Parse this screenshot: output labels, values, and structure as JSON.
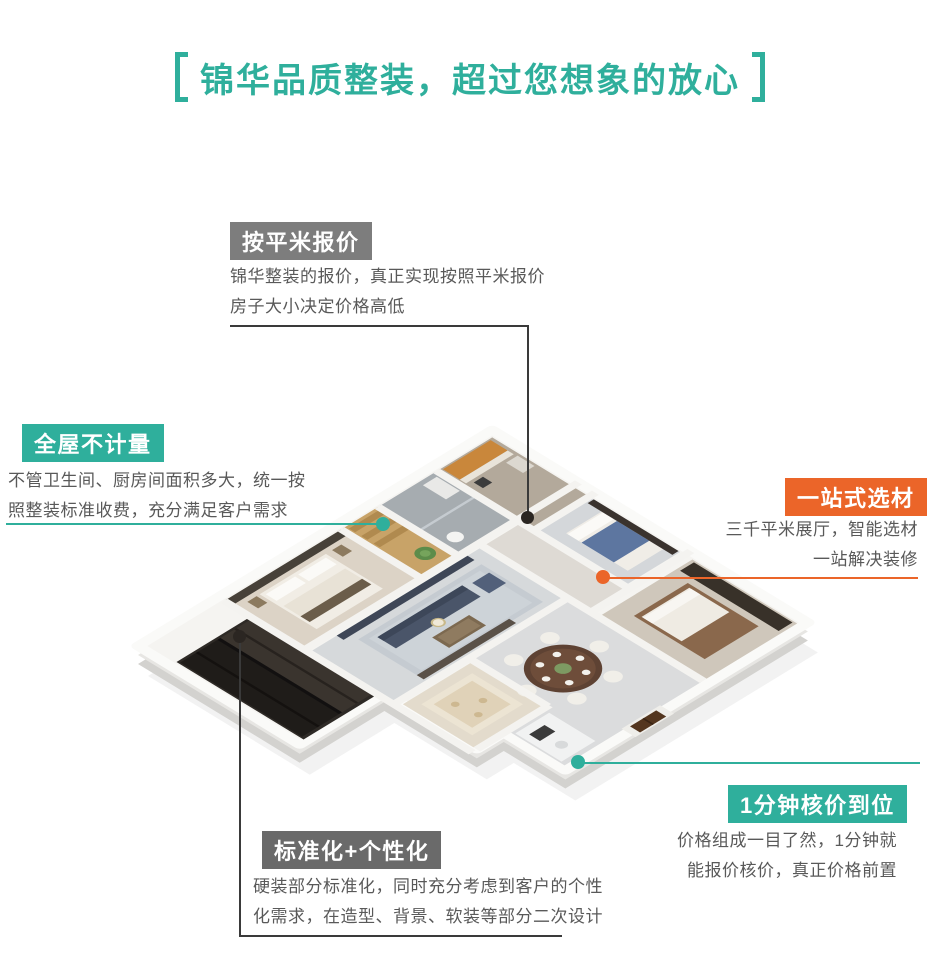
{
  "page": {
    "title": "锦华品质整装，超过您想象的放心"
  },
  "colors": {
    "teal": "#2FAF9C",
    "orange": "#EB6529",
    "gray_label": "#7D7D7D",
    "dark_gray_label": "#6A6A6A",
    "connector_dark": "#3A3A3A",
    "body_text": "#595959"
  },
  "callouts": [
    {
      "id": "price-per-sqm",
      "label": "按平米报价",
      "accent": "gray",
      "lines": [
        "锦华整装的报价，真正实现按照平米报价",
        "房子大小决定价格高低"
      ]
    },
    {
      "id": "whole-house-no-metering",
      "label": "全屋不计量",
      "accent": "teal",
      "lines": [
        "不管卫生间、厨房间面积多大，统一按",
        "照整装标准收费，充分满足客户需求"
      ]
    },
    {
      "id": "one-stop-materials",
      "label": "一站式选材",
      "accent": "orange",
      "lines": [
        "三千平米展厅，智能选材",
        "一站解决装修"
      ]
    },
    {
      "id": "one-minute-pricing",
      "label": "1分钟核价到位",
      "accent": "teal",
      "lines": [
        "价格组成一目了然，1分钟就",
        "能报价核价，真正价格前置"
      ]
    },
    {
      "id": "standardized-personalized",
      "label": "标准化+个性化",
      "accent": "dark_gray",
      "lines": [
        "硬装部分标准化，同时充分考虑到客户的个性",
        "化需求，在造型、背景、软装等部分二次设计"
      ]
    }
  ]
}
